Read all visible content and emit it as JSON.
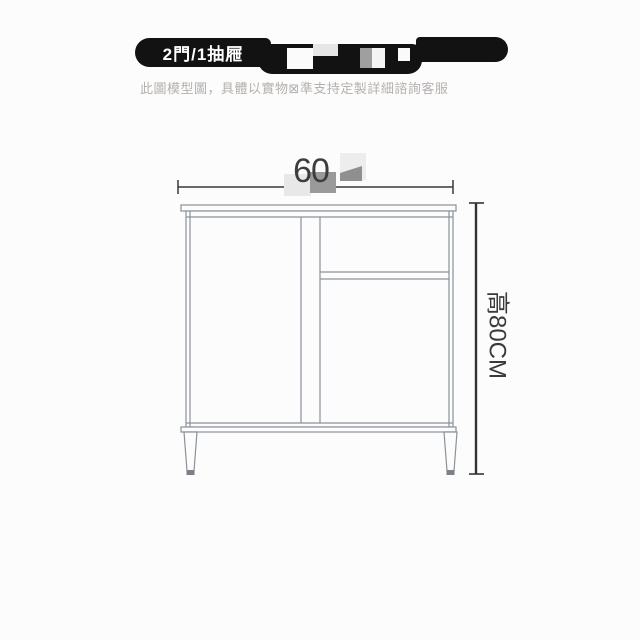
{
  "page": {
    "background_color": "#fcfcfc"
  },
  "banner": {
    "label": "2門/1抽屜",
    "background_color": "#121212",
    "text_color": "#ffffff",
    "redaction_block_colors": [
      "#fbfbfb",
      "#e6e6e6",
      "#9f9f9f",
      "#f4f4f4",
      "#fafafa"
    ]
  },
  "disclaimer": {
    "text": "此圖模型圖，具體以實物⊠準支持定製詳細諮詢客服",
    "color": "#b3b0ad"
  },
  "diagram": {
    "width_label": "60",
    "width_value_cm": 60,
    "height_label": "高80CM",
    "height_value_cm": 80,
    "outline_color": "#8b9198",
    "dimension_color": "#333333",
    "watermark_colors": [
      "#e8e8e8",
      "#9a9a9a",
      "#ededed",
      "#8f8f8f"
    ]
  }
}
